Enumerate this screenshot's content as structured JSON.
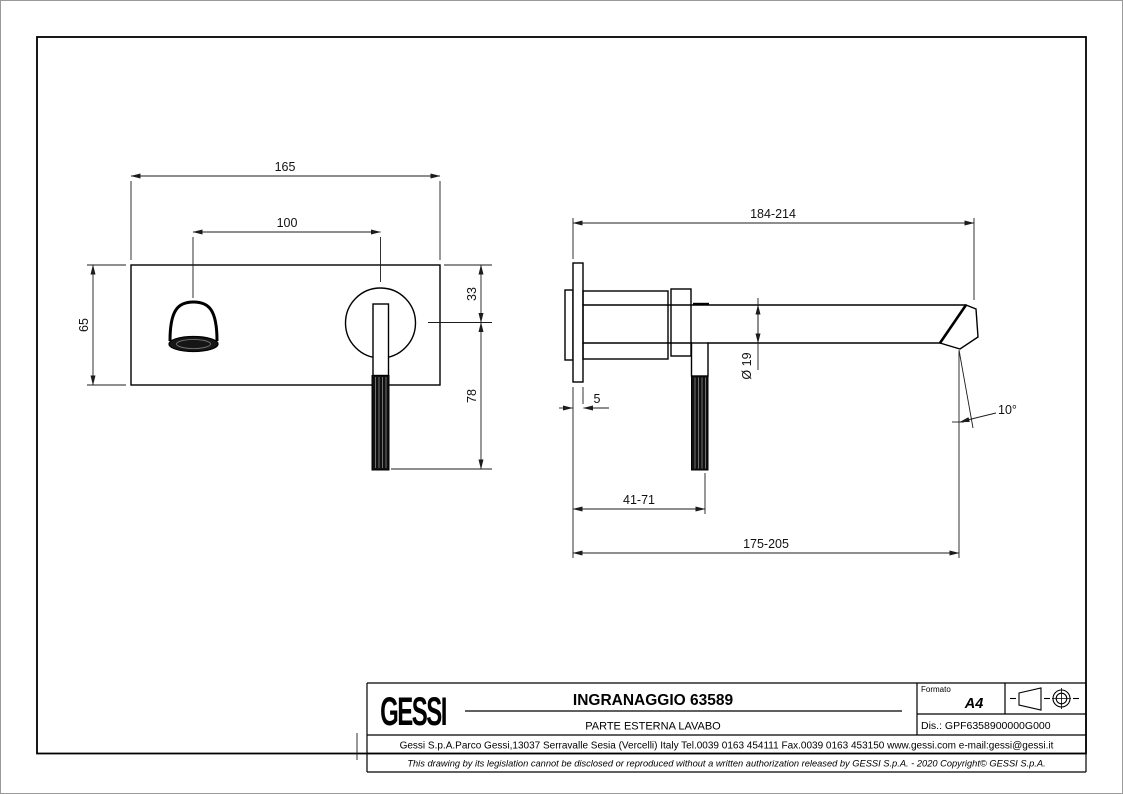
{
  "page": {
    "width": 1123,
    "height": 794,
    "background": "#ffffff",
    "line_color": "#000000"
  },
  "title_block": {
    "logo_text": "GESSI",
    "title": "INGRANAGGIO 63589",
    "subtitle": "PARTE ESTERNA LAVABO",
    "format_label": "Formato",
    "format_value": "A4",
    "drawing_number": "Dis.: GPF6358900000G000",
    "address": "Gessi S.p.A.Parco Gessi,13037 Serravalle Sesia (Vercelli) Italy Tel.0039 0163 454111 Fax.0039 0163 453150 www.gessi.com e-mail:gessi@gessi.it",
    "disclaimer": "This drawing by its legislation cannot be disclosed or reproduced without a written authorization released by GESSI S.p.A. - 2020 Copyright© GESSI S.p.A.",
    "projection_symbol": "first-angle-projection-icon"
  },
  "front_view": {
    "dimensions": {
      "plate_width": "165",
      "hole_spacing": "100",
      "plate_height": "65",
      "axis_offset_top": "33",
      "handle_below_axis": "78"
    }
  },
  "side_view": {
    "dimensions": {
      "reach": "184-214",
      "plate_thickness": "5",
      "spout_diameter": "Ø 19",
      "handle_offset": "41-71",
      "lower_reach": "175-205",
      "spout_angle": "10°"
    }
  }
}
